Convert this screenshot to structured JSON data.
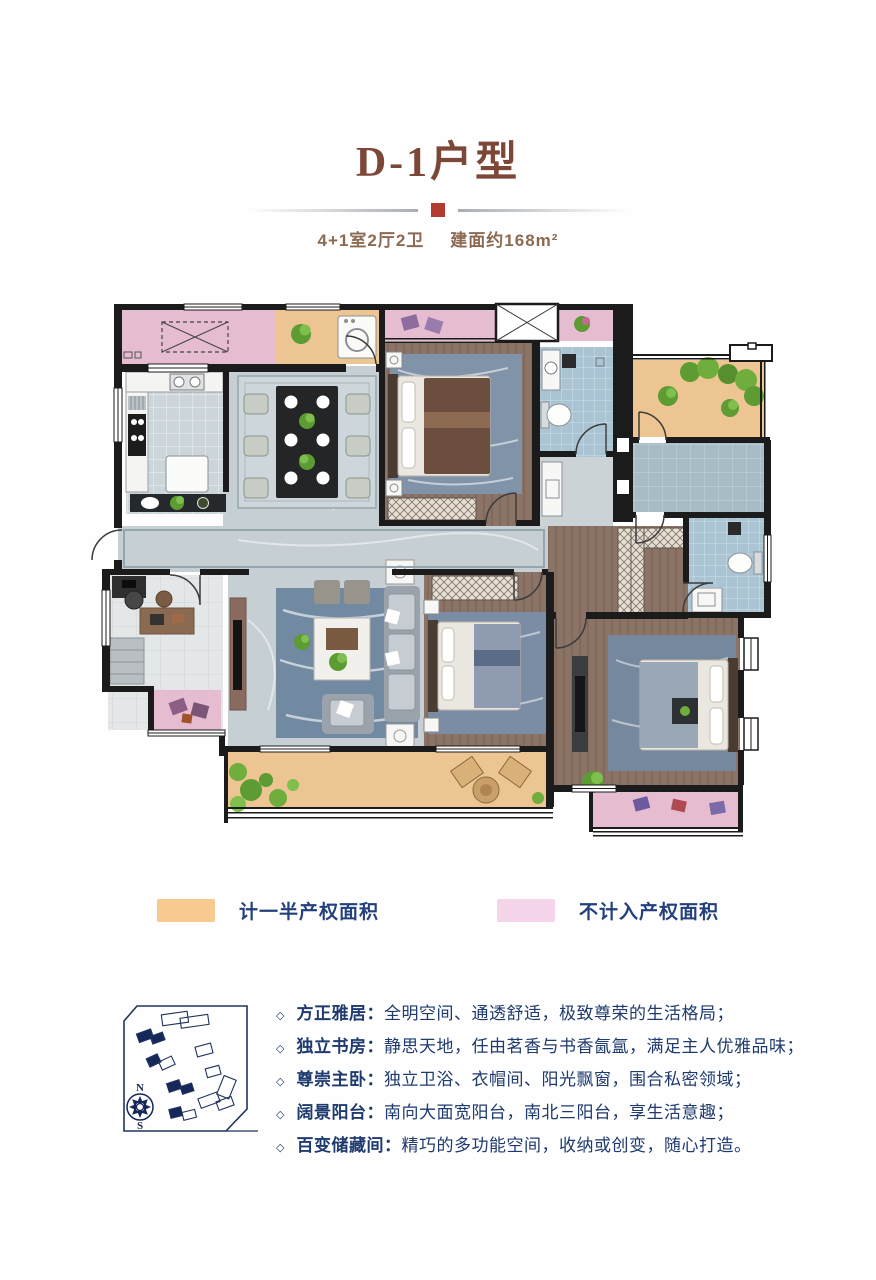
{
  "header": {
    "title": "D-1户型",
    "title_color": "#7d4737",
    "divider_accent_color": "#b23a30",
    "layout_spec": "4+1室2厅2卫",
    "area_spec": "建面约168m²",
    "subtitle_color": "#8c6a52"
  },
  "legend": {
    "text_color": "#24407c",
    "items": [
      {
        "label": "计一半产权面积",
        "color": "#f7ca90"
      },
      {
        "label": "不计入产权面积",
        "color": "#f4d5e9"
      }
    ]
  },
  "compass": {
    "north": "N",
    "south": "S"
  },
  "features": {
    "bullet": "◇",
    "text_color": "#1e3a6e",
    "items": [
      {
        "name": "方正雅居：",
        "desc": "全明空间、通透舒适，极致尊荣的生活格局；"
      },
      {
        "name": "独立书房：",
        "desc": "静思天地，任由茗香与书香氤氲，满足主人优雅品味；"
      },
      {
        "name": "尊崇主卧：",
        "desc": "独立卫浴、衣帽间、阳光飘窗，围合私密领域；"
      },
      {
        "name": "阔景阳台：",
        "desc": "南向大面宽阳台，南北三阳台，享生活意趣；"
      },
      {
        "name": "百变储藏间：",
        "desc": "精巧的多功能空间，收纳或创变，随心打造。"
      }
    ]
  },
  "floorplan_colors": {
    "wall": "#1b1b1b",
    "stone_floor": "#c5cfd4",
    "wood_floor": "#8b7365",
    "bath_tile": "#aac4d3",
    "kitchen_tile": "#ccd6da",
    "study_floor": "#e4e7e8",
    "half_area_orange": "#ecc592",
    "excluded_pink": "#e6bcd1",
    "rug_blue": "#76889d",
    "plant_green": "#5c9c33"
  }
}
